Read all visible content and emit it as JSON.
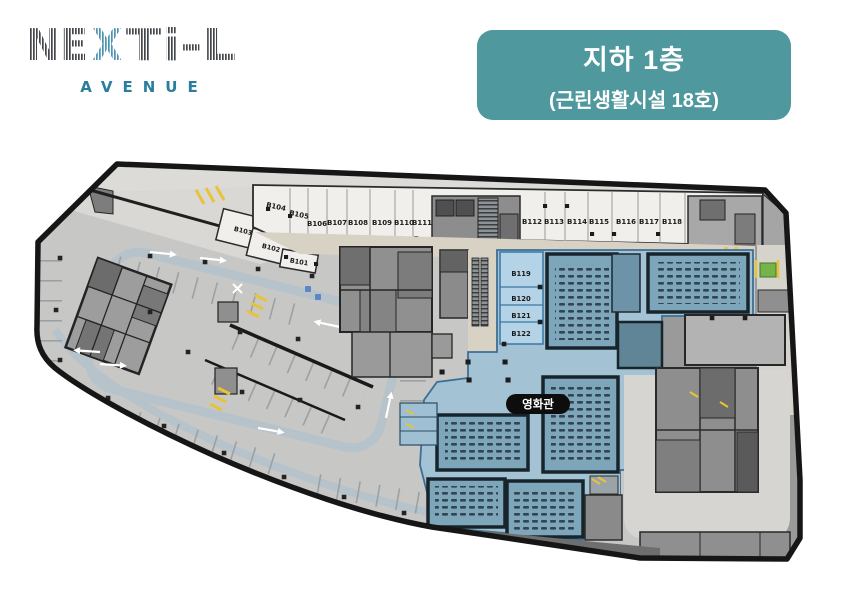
{
  "logo": {
    "part1": "NE",
    "part2": "X",
    "part3": "Ti-L",
    "subtitle": "AVENUE"
  },
  "header": {
    "floor_title": "지하 1층",
    "floor_subtitle": "(근린생활시설 18호)"
  },
  "plan": {
    "cinema_label": "영화관",
    "units": {
      "left_diagonal": [
        "B103",
        "B102",
        "B101"
      ],
      "top_row_left": [
        "B104",
        "B105",
        "B106",
        "B107",
        "B108",
        "B109",
        "B110",
        "B111"
      ],
      "top_row_right": [
        "B112",
        "B113",
        "B114",
        "B115",
        "B116",
        "B117",
        "B118"
      ],
      "cinema_column": [
        "B119",
        "B120",
        "B121",
        "B122"
      ]
    },
    "colors": {
      "accent_teal": "#4f989d",
      "logo_teal": "#2b7e9b",
      "logo_dark": "#43474c",
      "outline": "#161616",
      "parking_fill": "#c7c7c6",
      "unit_fill": "#f0efec",
      "corridor_fill": "#d8d2c5",
      "cinema_fill": "#a3c2d3",
      "cinema_room_fill": "#b5d3e6",
      "auditorium_fill": "#7ea6bb",
      "boh_fill": "#909090",
      "ramp_fill": "#d6d5d1",
      "road_stroke": "#b6c3cb",
      "green_area": "#76b44a",
      "yellow_marking": "#e8c33a"
    }
  }
}
